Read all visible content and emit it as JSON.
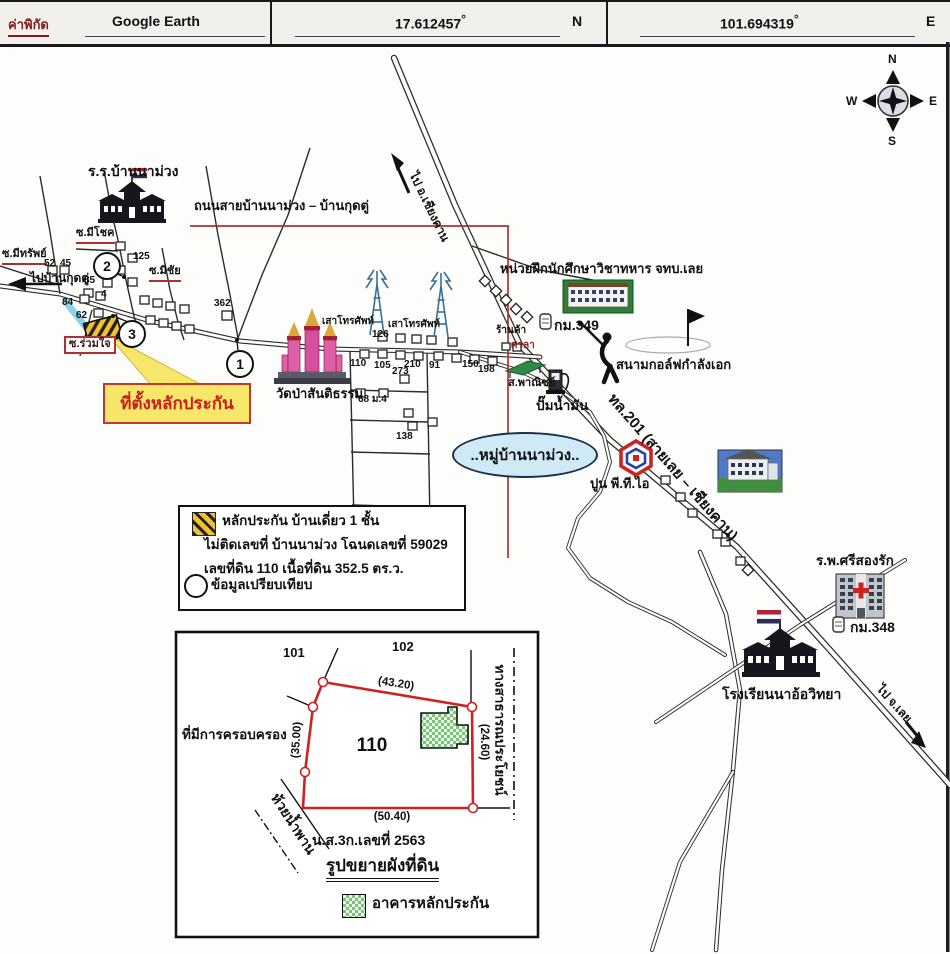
{
  "header": {
    "coord_label": "ค่าพิกัด",
    "source": "Google Earth",
    "latitude": "17.612457",
    "longitude": "101.694319",
    "degree": "°",
    "north": "N",
    "east": "E"
  },
  "compass": {
    "n": "N",
    "e": "E",
    "s": "S",
    "w": "W"
  },
  "map": {
    "school_ban_nam_muang": "ร.ร.บ้านนาม่วง",
    "road_label": "ถนนสายบ้านนาม่วง – บ้านกุดตู่",
    "soi_mi_chok": "ซ.มีโชค",
    "soi_mi_sap": "ซ.มีทรัพย์",
    "soi_mi_chai": "ซ.มีชัย",
    "soi_ruam_jai": "ซ.ร่วมใจ",
    "to_ban_kut_tu": "ไปบ้านกุดตู่",
    "to_chiang_khan": "ไป อ.เชียงคาน",
    "to_loei": "ไป จ.เลย",
    "collateral_callout": "ที่ตั้งหลักประกัน",
    "telephone_tower_1": "เสาโทรศัพท์",
    "telephone_tower_2": "เสาโทรศัพท์",
    "temple_wat_pa": "วัดป่าสันติธรรม",
    "military_training_unit": "หน่วยฝึกนักศึกษาวิชาทหาร จทบ.เลย",
    "km349": "กม.349",
    "km348": "กม.348",
    "golf_course": "สนามกอล์ฟกำลังเอก",
    "shop": "ร้านค้า",
    "sala": "ศาลา",
    "commercial": "ส.พาณิชย์",
    "gas_station": "ปั๊มน้ำมัน",
    "highway_201": "ทล.201 (สายเลย – เชียงคาน)",
    "village_ellipse": "..หมู่บ้านนาม่วง..",
    "cement_pti": "ปูน พี.ที.ไอ",
    "hospital": "ร.พ.ศรีสองรัก",
    "school_na_o": "โรงเรียนนาอ้อวิทยา",
    "nums": {
      "n52": "52",
      "n45": "45",
      "n125": "125",
      "n85": "85",
      "n4": "4",
      "n84": "84",
      "n62": "62",
      "n362": "362",
      "n126": "126",
      "n110": "110",
      "n105": "105",
      "n210": "210",
      "n91": "91",
      "n273": "273",
      "n150": "150",
      "n198": "198",
      "n68": "68 ม.4",
      "n138": "138"
    },
    "markers": {
      "m1": "1",
      "m2": "2",
      "m3": "3"
    }
  },
  "legend": {
    "item1": "หลักประกัน บ้านเดี่ยว 1 ชั้น",
    "item2": "ไม่ติดเลขที่ บ้านนาม่วง โฉนดเลขที่ 59029",
    "item3": "เลขที่ดิน 110 เนื้อที่ดิน 352.5 ตร.ว.",
    "item4": "ข้อมูลเปรียบเทียบ"
  },
  "inset": {
    "parcel_left": "101",
    "parcel_top": "102",
    "parcel_main": "110",
    "dim_top": "(43.20)",
    "dim_left": "(35.00)",
    "dim_right": "(24.60)",
    "dim_bottom": "(50.40)",
    "occupied_label": "ที่มีการครอบครอง",
    "stream_label": "ห้วยน้ำพาน",
    "public_road_label": "ทางสาธารณประโยชน์",
    "deed_no": "น.ส.3ก.เลขที่ 2563",
    "title": "รูปขยายผังที่ดิน",
    "building_legend": "อาคารหลักประกัน"
  },
  "colors": {
    "accent_red": "#b03030",
    "callout_yellow": "#f6e66a",
    "village_blue": "#cfeaf5",
    "hatch_yellow": "#f2c12e",
    "building_green": "#7ac47a"
  }
}
